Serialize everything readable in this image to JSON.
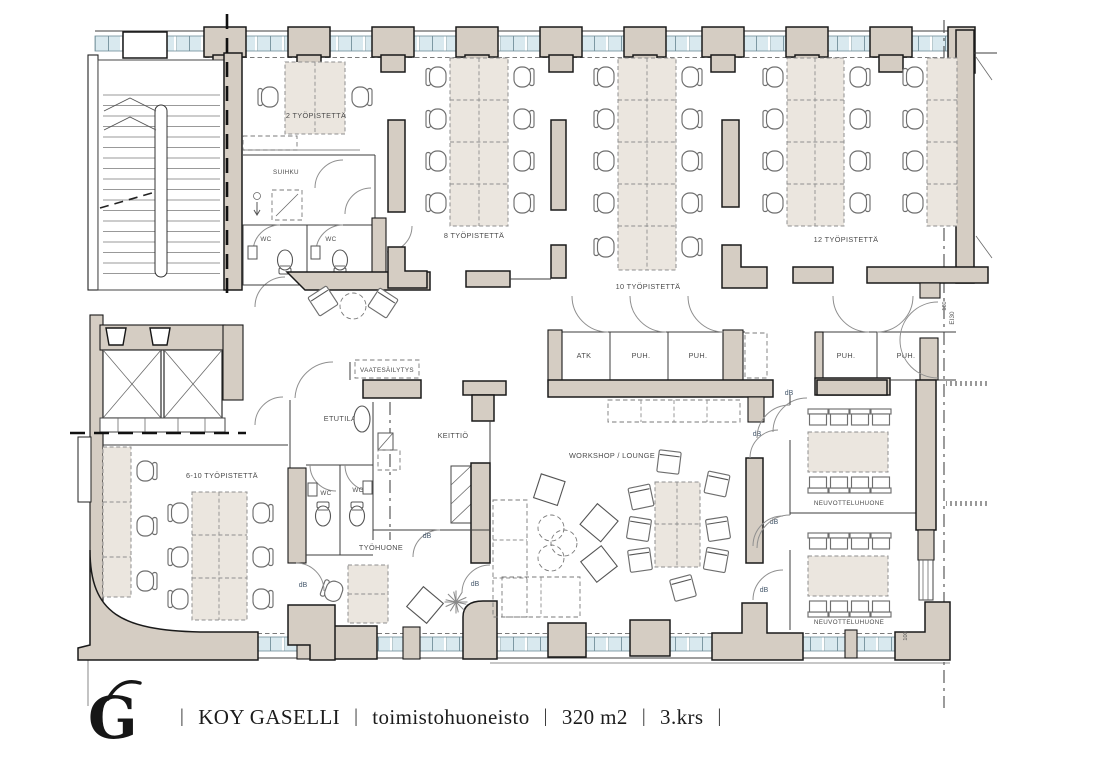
{
  "rooms": {
    "workstations_2": "2 TYÖPISTETTÄ",
    "workstations_8": "8 TYÖPISTETTÄ",
    "workstations_10": "10 TYÖPISTETTÄ",
    "workstations_12": "12 TYÖPISTETTÄ",
    "workstations_6_10": "6-10 TYÖPISTETTÄ",
    "shower": "SUIHKU",
    "wc": "WC",
    "atk": "ATK",
    "puh": "PUH.",
    "cloakroom": "VAATESÄILYTYS",
    "entry": "ETUTILA",
    "kitchen": "KEITTIÖ",
    "workshop_lounge": "WORKSHOP / LOUNGE",
    "office": "TYÖHUONE",
    "meeting_room": "NEUVOTTELUHUONE"
  },
  "annotations": {
    "sound_insulation": "dB",
    "fire_rating": "EI30",
    "door_mark": "180",
    "dim_mark": "100"
  },
  "footer": {
    "logo_letter": "G",
    "sep": "|",
    "company": "KOY GASELLI",
    "property_type": "toimistohuoneisto",
    "area": "320 m2",
    "floor": "3.krs"
  },
  "colors": {
    "wall_fill": "#d5cdc3",
    "window_glass": "#d9e9ef",
    "furniture_fill": "#ebe6df",
    "line": "#1a1a1a",
    "label_text": "#4b4b4b"
  }
}
